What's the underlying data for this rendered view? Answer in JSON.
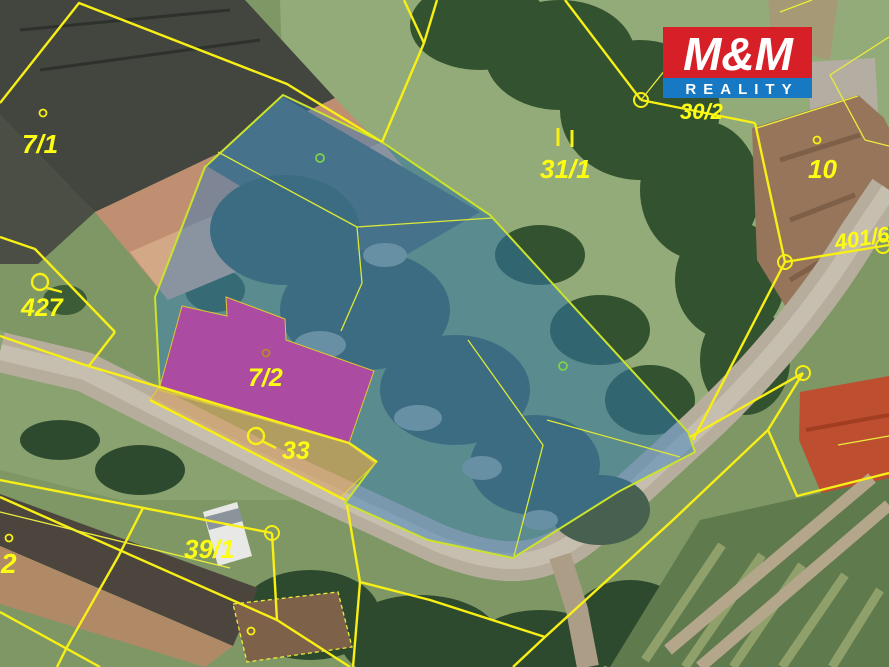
{
  "map": {
    "kind": "cadastral-aerial-map",
    "boundary_color": "#f7ef15",
    "highlight_parcel_fill": "#2e7cc2",
    "highlight_building_fill": "#d53fe6",
    "courtyard_strip_fill": "#dca35e"
  },
  "parcels": {
    "labels": [
      {
        "text": "7/1"
      },
      {
        "text": "427"
      },
      {
        "text": "7/2"
      },
      {
        "text": "33"
      },
      {
        "text": "39/1"
      },
      {
        "text": "2"
      },
      {
        "text": "31/1"
      },
      {
        "text": "30/2"
      },
      {
        "text": "10"
      },
      {
        "text": "401/6"
      }
    ]
  },
  "logo": {
    "name": "M&M Reality",
    "line1": "M&M",
    "line2": "REALITY",
    "red_bg": "#d61f26",
    "blue_bg": "#1779c4",
    "text_color": "#ffffff"
  }
}
